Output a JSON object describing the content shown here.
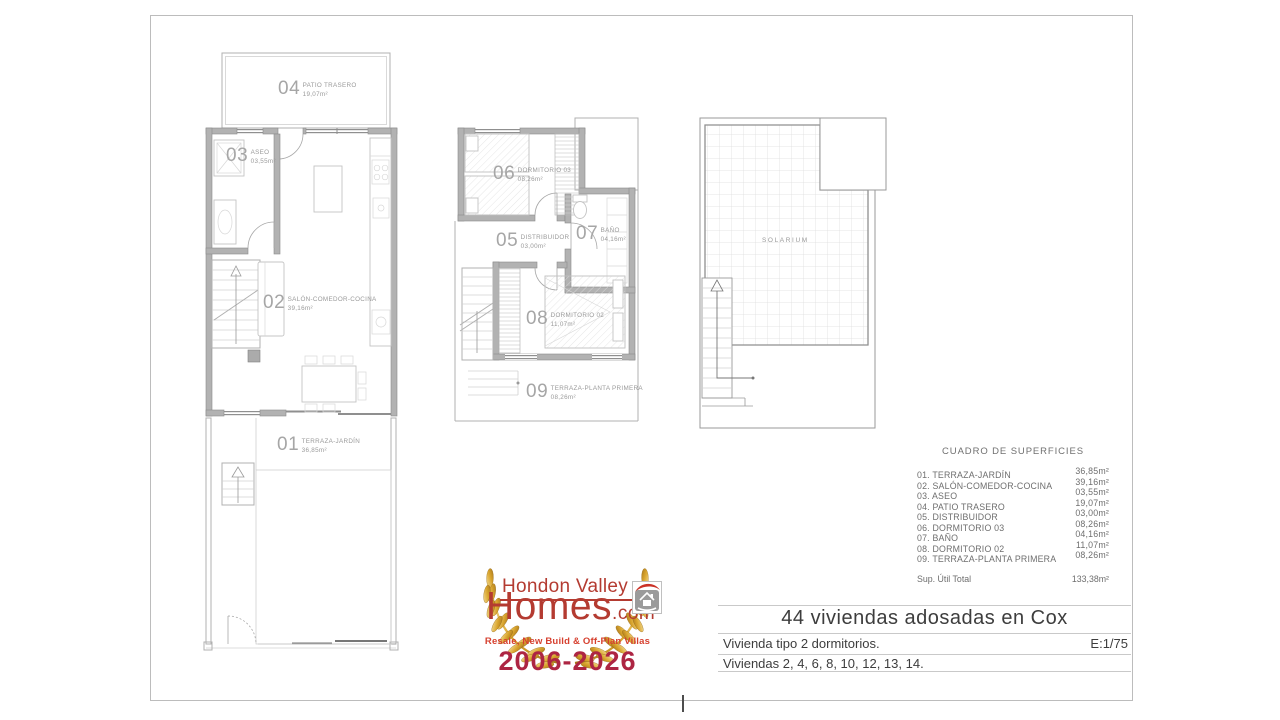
{
  "sheet": {
    "surface_table": {
      "title": "CUADRO DE SUPERFICIES",
      "rows": [
        {
          "label": "01. TERRAZA-JARDÍN",
          "value": "36,85m²"
        },
        {
          "label": "02. SALÓN-COMEDOR-COCINA",
          "value": "39,16m²"
        },
        {
          "label": "03. ASEO",
          "value": "03,55m²"
        },
        {
          "label": "04. PATIO TRASERO",
          "value": "19,07m²"
        },
        {
          "label": "05. DISTRIBUIDOR",
          "value": "03,00m²"
        },
        {
          "label": "06. DORMITORIO 03",
          "value": "08,26m²"
        },
        {
          "label": "07. BAÑO",
          "value": "04,16m²"
        },
        {
          "label": "08. DORMITORIO 02",
          "value": "11,07m²"
        },
        {
          "label": "09. TERRAZA-PLANTA PRIMERA",
          "value": "08,26m²"
        }
      ],
      "total_label": "Sup. Útil Total",
      "total_value": "133,38m²"
    },
    "title_block": {
      "project_title": "44 viviendas adosadas en Cox",
      "dwelling_type": "Vivienda tipo 2 dormitorios.",
      "scale": "E:1/75",
      "units_list": "Viviendas 2, 4, 6, 8, 10, 12, 13, 14."
    },
    "plans": {
      "ground_floor": {
        "patio": {
          "num": "04",
          "name": "PATIO TRASERO",
          "area": "19,07m²"
        },
        "aseo": {
          "num": "03",
          "name": "ASEO",
          "area": "03,55m²"
        },
        "salon": {
          "num": "02",
          "name": "SALÓN-COMEDOR-COCINA",
          "area": "39,16m²"
        },
        "terraza": {
          "num": "01",
          "name": "TERRAZA-JARDÍN",
          "area": "36,85m²"
        }
      },
      "first_floor": {
        "dormitorio3": {
          "num": "06",
          "name": "DORMITORIO 03",
          "area": "08,26m²"
        },
        "distribuidor": {
          "num": "05",
          "name": "DISTRIBUIDOR",
          "area": "03,00m²"
        },
        "bano": {
          "num": "07",
          "name": "BAÑO",
          "area": "04,16m²"
        },
        "dormitorio2": {
          "num": "08",
          "name": "DORMITORIO 02",
          "area": "11,07m²"
        },
        "terraza": {
          "num": "09",
          "name": "TERRAZA-PLANTA PRIMERA",
          "area": "08,26m²"
        }
      },
      "roof": {
        "solarium": "SOLARIUM"
      }
    },
    "logo": {
      "brand_top": "Hondon Valley",
      "brand_main": "Homes",
      "brand_tld": ".com",
      "tagline": "Resale, New Build & Off-Plan Villas",
      "years": "2006-2026",
      "colors": {
        "brand_red": "#b43b31",
        "bright_red": "#d6402f",
        "crimson": "#ad2543",
        "gold": "#d4a32c"
      }
    }
  }
}
